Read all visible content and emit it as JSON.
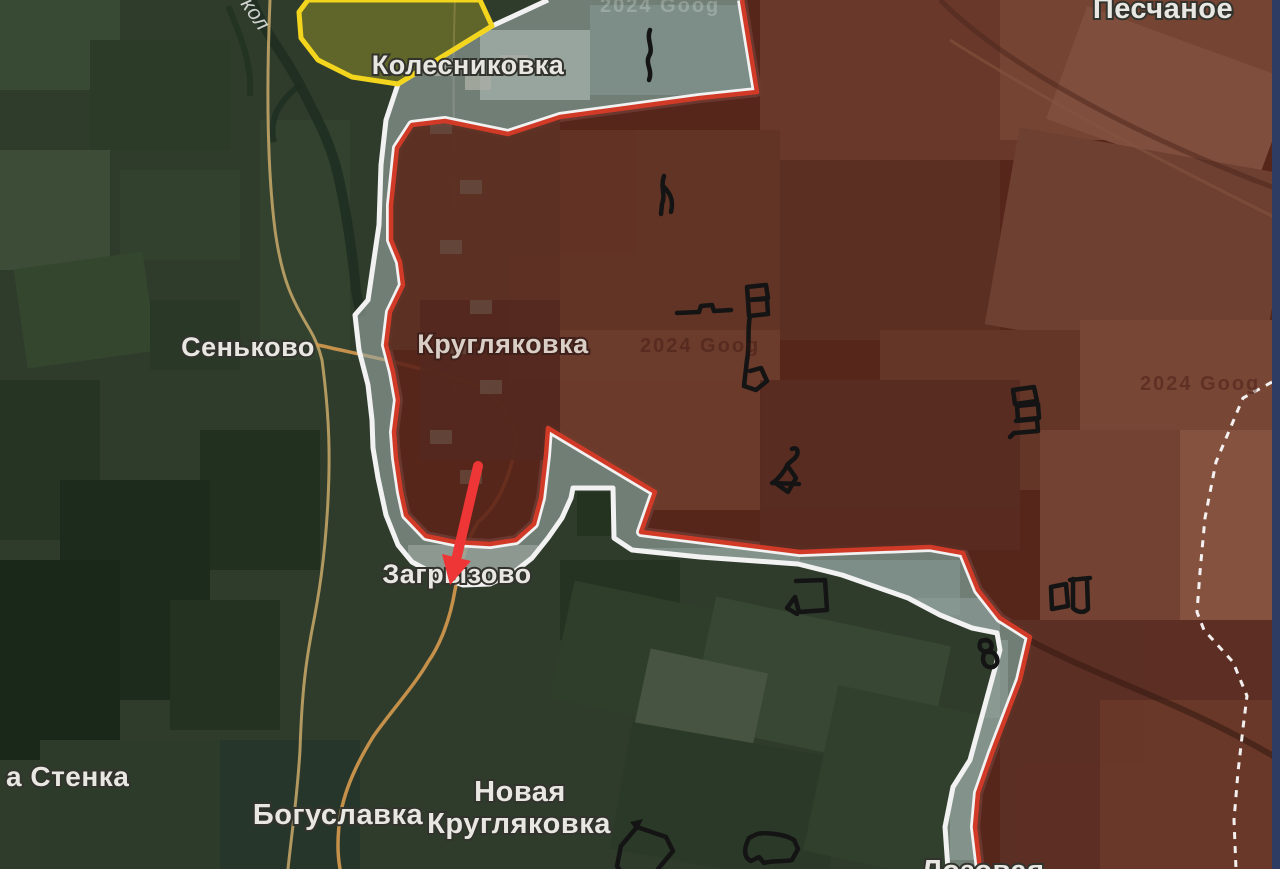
{
  "map": {
    "type": "military-situation-map",
    "labels": {
      "kolesnikovka": "Колесниковка",
      "senkovo": "Сеньково",
      "kruglyakovka": "Кругляковка",
      "zagryzovo": "Загрызово",
      "boguslavka": "Богуславка",
      "novaya_line1": "Новая",
      "novaya_line2": "Кругляковка",
      "peschanoe": "Песчаное",
      "stenka_partial": "а Стенка",
      "lozovaya": "Лозовая",
      "river_partial": "кол"
    },
    "watermark": {
      "text": "2024 Goog"
    },
    "zones": {
      "occupied": {
        "name": "occupied-area",
        "fill": "rgba(92,35,26,0.9)",
        "border": "#d23a28"
      },
      "contested": {
        "name": "grey-zone",
        "fill": "rgba(154,168,163,0.62)",
        "border": "#f2f2f2"
      },
      "liberated": {
        "name": "liberated-area",
        "fill": "rgba(158,153,38,0.45)",
        "border": "#f2d51c"
      },
      "boundary_dashed": "#ffffff"
    },
    "annotations": {
      "advance_arrow_color": "#ee3636",
      "position_marker_color": "#141414",
      "position_marker_count": 11
    }
  }
}
